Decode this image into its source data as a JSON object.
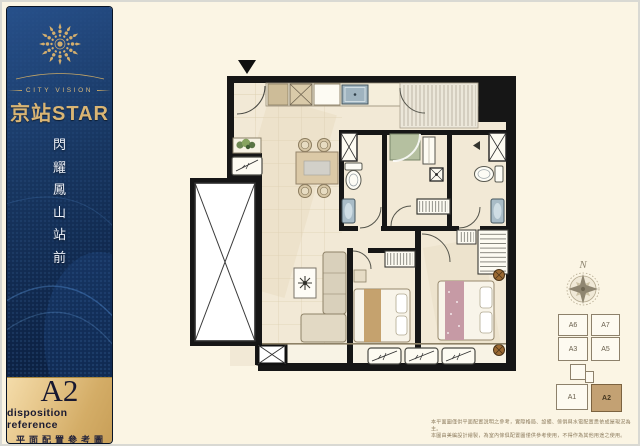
{
  "brand": {
    "tagline": "CITY VISION",
    "name": "京站STAR",
    "slogan_chars": [
      "閃",
      "耀",
      "鳳",
      "山",
      "站",
      "前"
    ]
  },
  "badge": {
    "unit": "A2",
    "subtitle_en": "disposition reference",
    "subtitle_zh": "平面配置參考圖"
  },
  "compass": {
    "north_label": "N"
  },
  "keyplan": {
    "units": [
      {
        "id": "A6",
        "label": "A6",
        "highlighted": false
      },
      {
        "id": "A7",
        "label": "A7",
        "highlighted": false
      },
      {
        "id": "A3",
        "label": "A3",
        "highlighted": false
      },
      {
        "id": "A5",
        "label": "A5",
        "highlighted": false
      },
      {
        "id": "A1",
        "label": "A1",
        "highlighted": false
      },
      {
        "id": "A2",
        "label": "A2",
        "highlighted": true
      }
    ],
    "highlight_color": "#c3a173"
  },
  "disclaimer": {
    "line1": "本平面圖僅供平面配置說明之參考，實際格局、設備、傢俱與水電配置悉依成屋現況為主。",
    "line2": "本圖由美編設計繪製，為室內傢俱配置圖僅供參考使用，不得作為其他用途之使用。"
  },
  "colors": {
    "sidebar_navy": "#12294d",
    "gold": "#d4af6e",
    "cream_bg": "#fbf5e4",
    "wall_black": "#161616",
    "keyplan_highlight": "#c3a173"
  }
}
